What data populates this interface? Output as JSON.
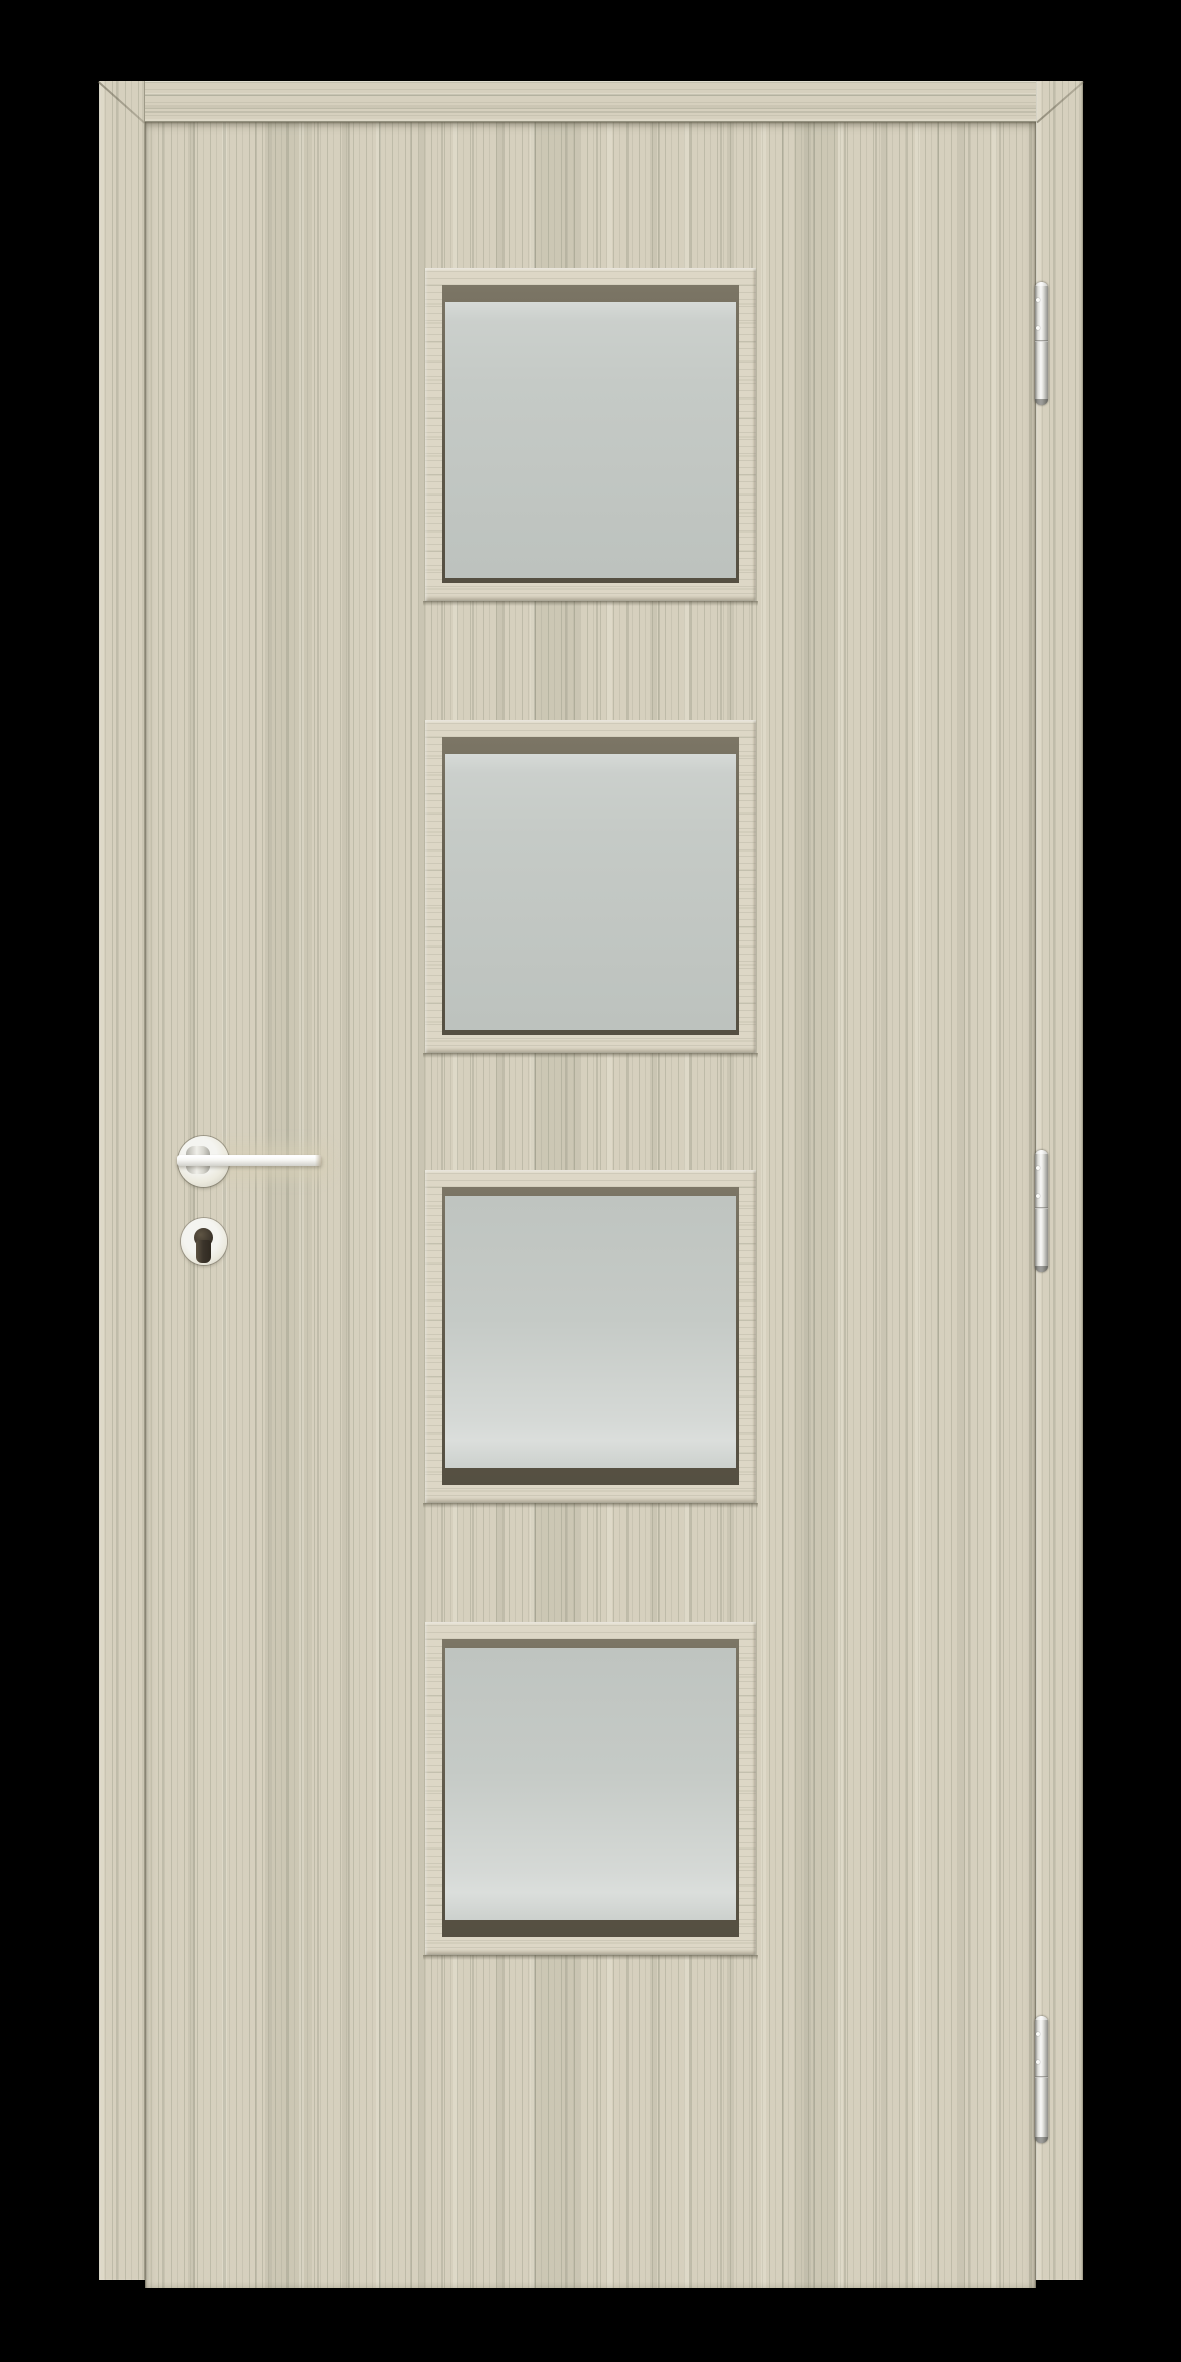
{
  "scene": {
    "type": "product-photo",
    "subject": "interior wooden door with frame, four frosted glass panels, lever handle and three hinges",
    "text_content": "none"
  },
  "door": {
    "finish": "light oak woodgrain laminate",
    "glazing_panel_count": 4,
    "glazing": "frosted satin glass",
    "hinge_count": 3,
    "hinge_side": "right",
    "handle_side": "left",
    "handle": "lever handle on round rose",
    "lock": "euro-profile cylinder escutcheon with keyhole",
    "hardware_finish": "satin silver"
  },
  "colors": {
    "background": "#000000",
    "wood-base": "#d6d0be",
    "wood-trim": "#ddd7c6",
    "rebate-dark": "#6a6352",
    "glass": "#c5cac6",
    "metal-light": "#f4f4f0",
    "metal-mid": "#d2d2cc",
    "metal-dark": "#8b8b85",
    "keyhole-dark": "#3a332a"
  }
}
